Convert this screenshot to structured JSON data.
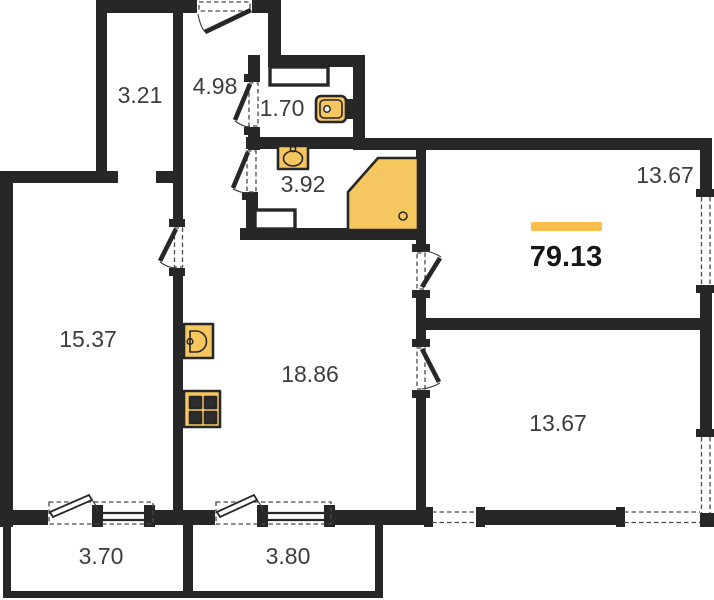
{
  "areas": {
    "closet": "3.21",
    "hallway": "4.98",
    "wc": "1.70",
    "bathroom": "3.92",
    "room_top_right": "13.67",
    "room_left": "15.37",
    "kitchen_living": "18.86",
    "room_bottom_right": "13.67",
    "balcony_left": "3.70",
    "balcony_right": "3.80",
    "total": "79.13"
  },
  "colors": {
    "wall": "#272727",
    "fixture_fill": "#F7C75F",
    "accent_bar": "#F9BD4B",
    "label_text": "#3d3d3d"
  }
}
